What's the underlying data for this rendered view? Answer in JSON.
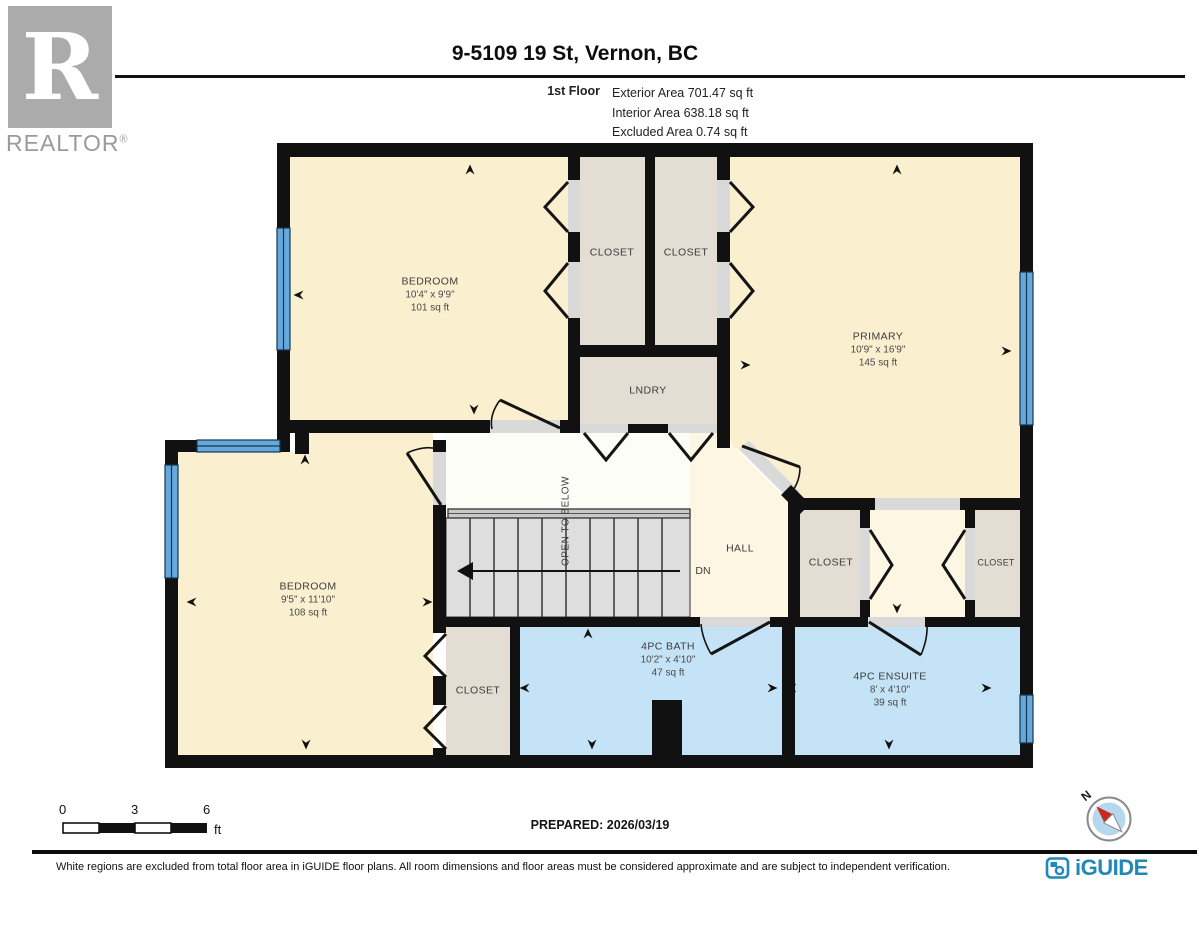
{
  "header": {
    "logo_text": "R",
    "logo_caption": "REALTOR",
    "logo_reg": "®",
    "title": "9-5109 19 St, Vernon, BC",
    "floor_label": "1st Floor",
    "stats": [
      "Exterior Area 701.47 sq ft",
      "Interior Area 638.18 sq ft",
      "Excluded Area 0.74 sq ft"
    ]
  },
  "rooms": {
    "bedroom_top": {
      "name": "BEDROOM",
      "dims": "10'4\" x 9'9\"",
      "area": "101 sq ft"
    },
    "closet_top_a": {
      "name": "CLOSET"
    },
    "closet_top_b": {
      "name": "CLOSET"
    },
    "primary": {
      "name": "PRIMARY",
      "dims": "10'9\" x 16'9\"",
      "area": "145 sq ft"
    },
    "laundry": {
      "name": "LNDRY"
    },
    "bedroom_left": {
      "name": "BEDROOM",
      "dims": "9'5\" x 11'10\"",
      "area": "108 sq ft"
    },
    "hall": {
      "name": "HALL"
    },
    "closet_hall": {
      "name": "CLOSET"
    },
    "closet_primary": {
      "name": "CLOSET"
    },
    "closet_bedroom": {
      "name": "CLOSET"
    },
    "bath": {
      "name": "4PC BATH",
      "dims": "10'2\" x 4'10\"",
      "area": "47 sq ft"
    },
    "ensuite": {
      "name": "4PC ENSUITE",
      "dims": "8' x 4'10\"",
      "area": "39 sq ft"
    }
  },
  "stairs": {
    "open_below": "OPEN TO BELOW",
    "down_label": "DN"
  },
  "footer": {
    "scale": {
      "t0": "0",
      "t3": "3",
      "t6": "6",
      "unit": "ft"
    },
    "prepared": "PREPARED: 2026/03/19",
    "compass_n": "N",
    "disclaimer": "White regions are excluded from total floor area in iGUIDE floor plans. All room dimensions and floor areas must be considered approximate and are subject to independent verification.",
    "brand": "iGUIDE"
  },
  "colors": {
    "room": "#FAF0D0",
    "hall": "#FCF6E2",
    "closet": "#E4DDD3",
    "bath": "#C4E3F6",
    "window": "#64A9DC",
    "wall": "#111111",
    "open_below": "#FDFDF8",
    "brand": "#2188B8",
    "compass_red": "#C8291D",
    "logo_gray": "#ABABAB"
  }
}
